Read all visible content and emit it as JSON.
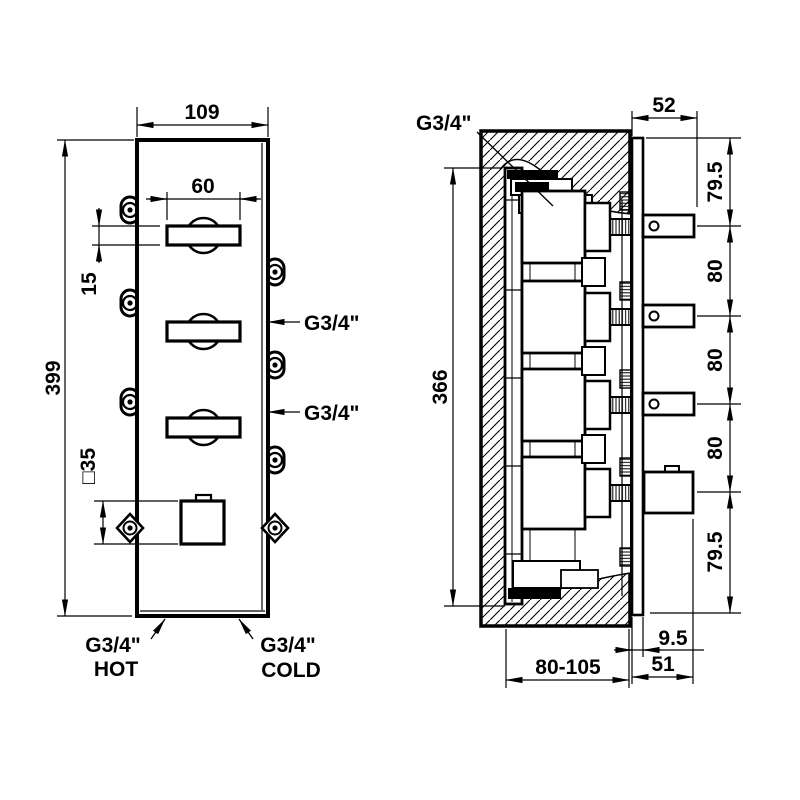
{
  "front_view": {
    "width": "109",
    "height": "399",
    "handle_width": "60",
    "handle_height": "15",
    "knob_size": "□35",
    "port_mid": "G3/4\"",
    "port_low": "G3/4\"",
    "hot_label": "G3/4\"",
    "hot_word": "HOT",
    "cold_label": "G3/4\"",
    "cold_word": "COLD"
  },
  "side_view": {
    "inlet_label": "G3/4\"",
    "handle_depth": "52",
    "top_offset": "79.5",
    "pitch_1": "80",
    "pitch_2": "80",
    "pitch_3": "80",
    "bottom_offset": "79.5",
    "body_height": "366",
    "plate_thickness": "9.5",
    "recess_depth": "80-105",
    "protrusion": "51"
  },
  "colors": {
    "line": "#000000",
    "background": "#ffffff"
  }
}
